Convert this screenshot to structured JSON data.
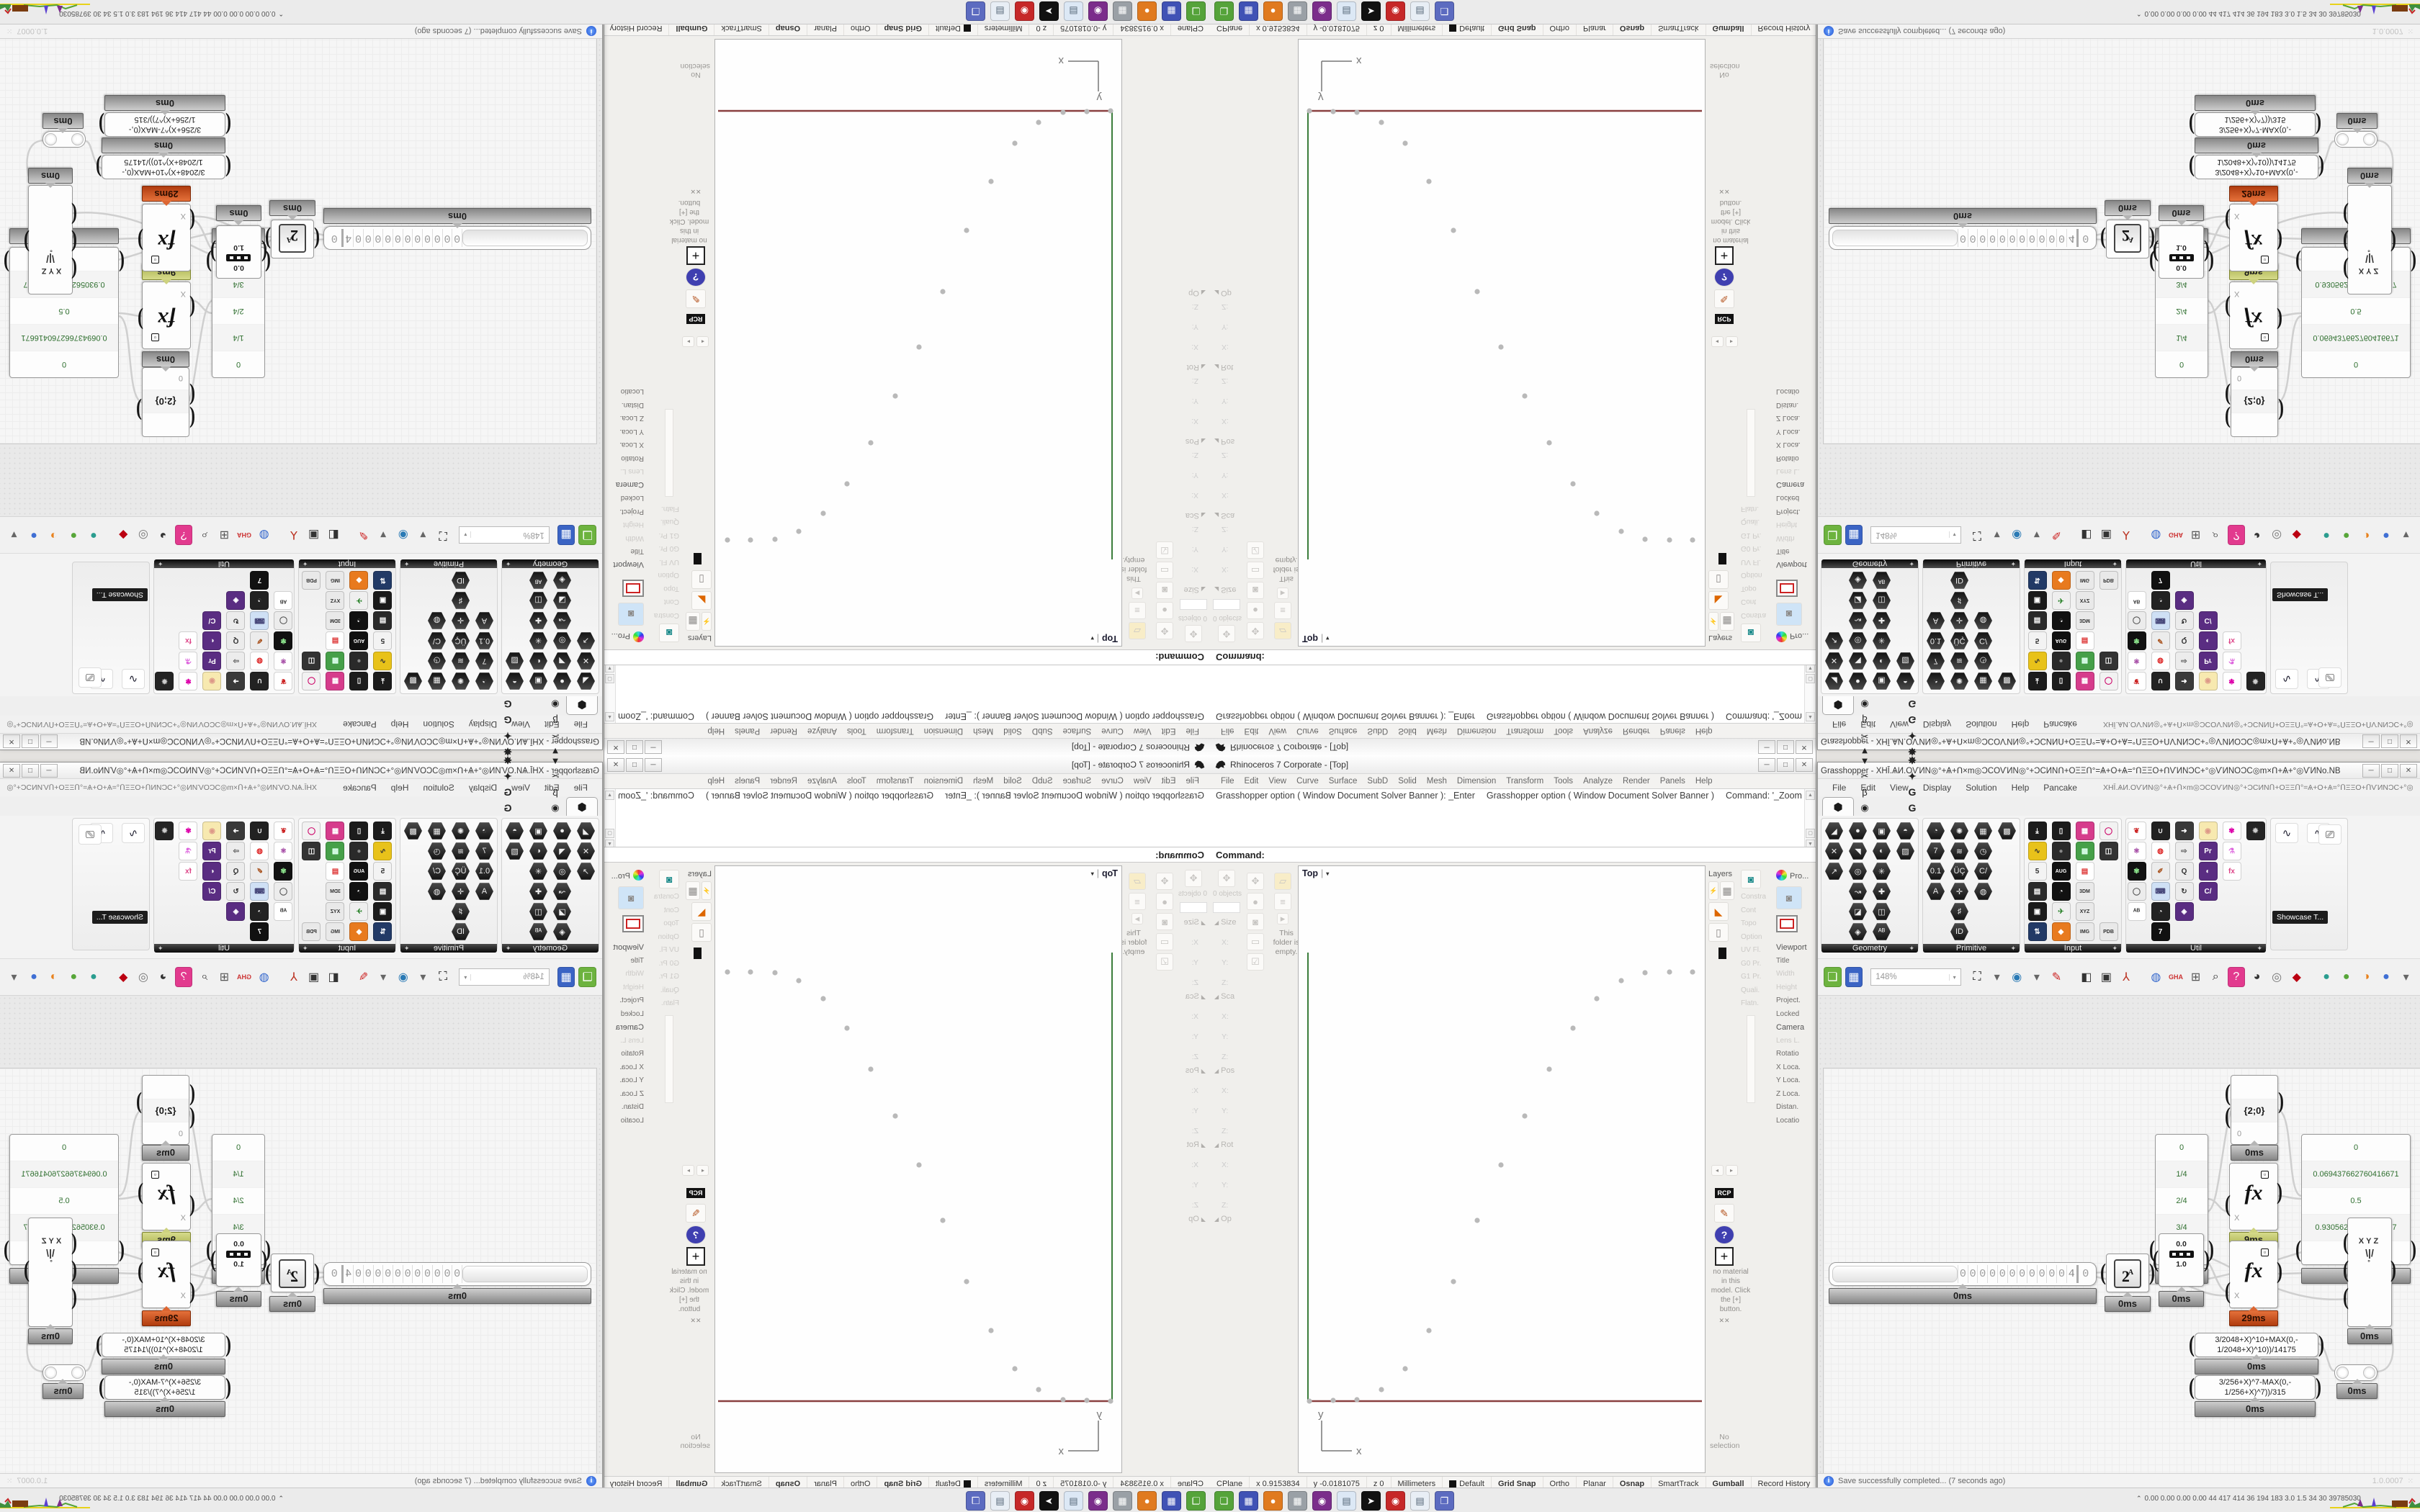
{
  "ui": {
    "hex_glyph": "⬢",
    "caret_down": "▾",
    "bracket_l": "(",
    "bracket_r": ")",
    "accent_red": "#b03c0f",
    "accent_olive": "#a9b14e",
    "wire_color": "#cfcfcf"
  },
  "rhino": {
    "title": "Rhinoceros 7 Corporate - [Top]",
    "window_buttons": [
      "─",
      "□",
      "✕"
    ],
    "menu": [
      "File",
      "Edit",
      "View",
      "Curve",
      "Surface",
      "SubD",
      "Solid",
      "Mesh",
      "Dimension",
      "Transform",
      "Tools",
      "Analyze",
      "Render",
      "Panels",
      "Help"
    ],
    "command_history": [
      "Grasshopper option ( Window  Document  Solver  Banner ): _Enter",
      "Grasshopper option ( Window  Document  Solver  Banner )",
      "Command: '_Zoom",
      "Drag a window to zoom ( All  Dynamic  Extents  Factor  In  Out  Selected  Target  1To1 ):  Extents"
    ],
    "command_prompt": "Command:",
    "left_panel": {
      "objects_label": "0 objects",
      "sections": [
        {
          "h": "Size",
          "f": [
            "X:",
            "Y:",
            "Z:"
          ]
        },
        {
          "h": "Sca",
          "f": [
            "X:",
            "Y:",
            "Z:"
          ]
        },
        {
          "h": "Pos",
          "f": [
            "X:",
            "Y:",
            "Z:"
          ]
        },
        {
          "h": "Rot",
          "f": [
            "X:",
            "Y:",
            "Z:"
          ]
        },
        {
          "h": "Op",
          "f": []
        }
      ],
      "col_icons": [
        "✥",
        "●",
        "◙",
        "▭",
        "☑"
      ],
      "folder_icon": "▱",
      "menu_icon": "≡",
      "expand_icon": "▸",
      "folder_note": "This folder is empty."
    },
    "viewport": {
      "label": "Top",
      "dropdown": "▾",
      "axis_x_label": "x",
      "axis_y_label": "y",
      "x_axis_color": "#8a4040",
      "y_axis_color": "#3c7d3c",
      "point_color": "#b9b9b9",
      "points": [
        [
          15,
          743
        ],
        [
          48,
          742
        ],
        [
          81,
          741
        ],
        [
          115,
          727
        ],
        [
          148,
          698
        ],
        [
          181,
          645
        ],
        [
          215,
          577
        ],
        [
          248,
          492
        ],
        [
          281,
          415
        ],
        [
          314,
          347
        ],
        [
          348,
          282
        ],
        [
          381,
          225
        ],
        [
          414,
          184
        ],
        [
          448,
          159
        ],
        [
          481,
          148
        ],
        [
          515,
          147
        ],
        [
          547,
          147
        ]
      ]
    },
    "right_panels": {
      "layers_title": "Layers",
      "layers_icons": [
        "⚡",
        "▦",
        "◣",
        "▯"
      ],
      "properties_title": "Pro...",
      "gear_icon": "⚙",
      "viewport_section": [
        {
          "t": "Viewport",
          "c": "ptitle"
        },
        {
          "t": "Title",
          "c": "drk"
        },
        {
          "t": "Width",
          "c": "faded"
        },
        {
          "t": "Height",
          "c": "faded"
        },
        {
          "t": "Project.",
          "c": "drk"
        },
        {
          "t": "Locked",
          "c": "drk"
        }
      ],
      "camera_section": [
        {
          "t": "Camera",
          "c": "ptitle"
        },
        {
          "t": "Lens L.",
          "c": "faded"
        },
        {
          "t": "Rotatio",
          "c": "drk"
        },
        {
          "t": "X Loca.",
          "c": "drk"
        },
        {
          "t": "Y Loca.",
          "c": "drk"
        },
        {
          "t": "Z Loca.",
          "c": "drk"
        },
        {
          "t": "Distan.",
          "c": "drk"
        },
        {
          "t": "Locatio",
          "c": "drk"
        }
      ],
      "mid_items": [
        {
          "t": "Constra",
          "c": "faded"
        },
        {
          "t": "Cont",
          "c": "faded"
        },
        {
          "t": "Topo",
          "c": "faded"
        },
        {
          "t": "Option",
          "c": "faded"
        },
        {
          "t": "UV Fl.",
          "c": "faded"
        },
        {
          "t": "G0 Pr.",
          "c": "faded"
        },
        {
          "t": "G1 Pr.",
          "c": "faded"
        },
        {
          "t": "Quali.",
          "c": "faded"
        },
        {
          "t": "Flatn.",
          "c": "faded"
        }
      ],
      "rcp_label": "RCP",
      "pencil_icon": "✎",
      "help_icon": "?",
      "plus_icon": "+",
      "material_note": "no material in this model. Click the [+] button.",
      "no_selection": "No selection"
    },
    "statusbar": [
      {
        "t": "CPlane"
      },
      {
        "t": "x 0.9153834"
      },
      {
        "t": "y -0.0181075"
      },
      {
        "t": "z 0"
      },
      {
        "t": "Millimeters"
      },
      {
        "t": "Default",
        "swatch": true
      },
      {
        "t": "Grid Snap",
        "b": true
      },
      {
        "t": "Ortho"
      },
      {
        "t": "Planar"
      },
      {
        "t": "Osnap",
        "b": true
      },
      {
        "t": "SmartTrack"
      },
      {
        "t": "Gumball",
        "b": true
      },
      {
        "t": "Record History"
      },
      {
        "t": "Filter"
      }
    ]
  },
  "grasshopper": {
    "title": "Grasshopper - XHĪ.ѦИ.ОѴИΝ◎°+Ѧ+Ո×m◎ϽϹΟѴИΝ◎°+ϽϹИΝՈ+ΟΞΞՈ°=Ѧ+Ο+Ѧ=°ՈΞΞΟ+ՈѴИΝϽϹ+°◎ѴИΝΟϽϹ◎m×Ո+Ѧ+°◎ѴИΝο.NB",
    "window_buttons": [
      "─",
      "□",
      "✕"
    ],
    "menu": [
      "File",
      "Edit",
      "View",
      "Display",
      "Solution",
      "Help",
      "Pancake"
    ],
    "menu_doc": "XHĪ.ѦИ.ОѴИΝ◎°+Ѧ+Ո×m◎ϽϹΟѴИΝ◎°+ϽϹИΝՈ+ΟΞΞՈ°=Ѧ+Ο+Ѧ=°ՈΞΞΟ+ՈѴИΝϽϹ+°◎ѴИΝΟϽϹ◎m×Ո+Ѧ+°◎ѴИΝο.NB",
    "params_tab_glyph": "⬢",
    "tabs_glyphs": [
      "Σ",
      "Ψ",
      "↗",
      "↺",
      "◗",
      "▼",
      "✂",
      "β",
      "◉"
    ],
    "tabs_letters": [
      "A",
      "❀",
      "A",
      "B",
      "▲",
      "B",
      "◈",
      "♞",
      "D",
      "E",
      "E",
      "E",
      "F",
      "✱",
      "✸",
      "✦",
      "G",
      "G"
    ],
    "ribbon": [
      {
        "name": "Geometry",
        "cols": 4,
        "style": "hex",
        "icons": [
          "◢",
          "●",
          "▣",
          "◓",
          "✕",
          "◥",
          "◐",
          "▨",
          "↗",
          "◎",
          "✳",
          "",
          "",
          "↝",
          "✚",
          "",
          "",
          "◪",
          "◫",
          "",
          "",
          "◈",
          "ᴬᴮ",
          ""
        ]
      },
      {
        "name": "Primitive",
        "cols": 4,
        "style": "hex",
        "icons": [
          "◔",
          "✺",
          "▦",
          "▩",
          "7",
          "≋",
          "◷",
          "",
          "0.1",
          "ÜÇ",
          "C/",
          "",
          "A",
          "✛",
          "◍",
          "",
          "",
          "♯",
          "",
          "",
          "",
          "ID",
          "",
          ""
        ]
      },
      {
        "name": "Input",
        "cols": 4,
        "style": "color",
        "icons": [
          {
            "g": "⤓",
            "b": "#1c1c1c",
            "f": "#fff"
          },
          {
            "g": "▯",
            "b": "#1c1c1c",
            "f": "#fff"
          },
          {
            "g": "▦",
            "b": "#d63c8c",
            "f": "#fff"
          },
          {
            "g": "◯",
            "b": "#f2f2f2",
            "f": "#c06"
          },
          {
            "g": "∿",
            "b": "#e8c21a",
            "f": "#333"
          },
          {
            "g": "●",
            "b": "#2a2a2a",
            "f": "#888"
          },
          {
            "g": "▩",
            "b": "#46a049",
            "f": "#dfe"
          },
          {
            "g": "◫",
            "b": "#333",
            "f": "#fff"
          },
          {
            "g": "5",
            "b": "#f3f3f3",
            "f": "#333"
          },
          {
            "g": "AUG",
            "b": "#111",
            "f": "#fff"
          },
          {
            "g": "▤",
            "b": "#fff",
            "f": "#d33"
          },
          {
            "g": ""
          },
          {
            "g": "▤",
            "b": "#2a2a2a",
            "f": "#fff"
          },
          {
            "g": "◔",
            "b": "#111",
            "f": "#fff"
          },
          {
            "g": "3DM",
            "b": "#e9e9e9",
            "f": "#333"
          },
          {
            "g": ""
          },
          {
            "g": "▣",
            "b": "#1a1a1a",
            "f": "#fff"
          },
          {
            "g": "✈",
            "b": "#efefef",
            "f": "#383"
          },
          {
            "g": "XYZ",
            "b": "#e9e9e9",
            "f": "#333"
          },
          {
            "g": ""
          },
          {
            "g": "⇅",
            "b": "#223a66",
            "f": "#fff"
          },
          {
            "g": "◆",
            "b": "#e87a1e",
            "f": "#fff"
          },
          {
            "g": "IMG",
            "b": "#e9e9e9",
            "f": "#333"
          },
          {
            "g": "PDB",
            "b": "#e9e9e9",
            "f": "#333"
          }
        ]
      },
      {
        "name": "Util",
        "cols": 6,
        "style": "color",
        "icons": [
          {
            "g": "❦",
            "b": "#fff",
            "f": "#c22"
          },
          {
            "g": "∪",
            "b": "#222",
            "f": "#eee"
          },
          {
            "g": "➜",
            "b": "#3a3a3a",
            "f": "#fff"
          },
          {
            "g": "◉",
            "b": "#f7e9b0",
            "f": "#d98"
          },
          {
            "g": "✾",
            "b": "#fff",
            "f": "#d0a"
          },
          {
            "g": "✹",
            "b": "#242424",
            "f": "#ccc"
          },
          {
            "g": "⚛",
            "b": "#fff",
            "f": "#939"
          },
          {
            "g": "◍",
            "b": "#fff",
            "f": "#d22"
          },
          {
            "g": "⇨",
            "b": "#ececec",
            "f": "#555"
          },
          {
            "g": "Pr",
            "b": "#5a2d82",
            "f": "#fff"
          },
          {
            "g": "⚗",
            "b": "#fff",
            "f": "#d6d"
          },
          {
            "g": ""
          },
          {
            "g": "✾",
            "b": "#111",
            "f": "#8d8"
          },
          {
            "g": "✐",
            "b": "#ececec",
            "f": "#a52"
          },
          {
            "g": "Q",
            "b": "#ececec",
            "f": "#333"
          },
          {
            "g": "◐",
            "b": "#5a2d82",
            "f": "#fff"
          },
          {
            "g": "fx",
            "b": "#fff",
            "f": "#d48"
          },
          {
            "g": ""
          },
          {
            "g": "◯",
            "b": "#ececec",
            "f": "#555"
          },
          {
            "g": "⌨",
            "b": "#cfe0f5",
            "f": "#447"
          },
          {
            "g": "↻",
            "b": "#ececec",
            "f": "#333"
          },
          {
            "g": "C/",
            "b": "#5a2d82",
            "f": "#fff"
          },
          {
            "g": ""
          },
          {
            "g": ""
          },
          {
            "g": "ᴬᴮ",
            "b": "#fff",
            "f": "#333"
          },
          {
            "g": "◔",
            "b": "#222",
            "f": "#fff"
          },
          {
            "g": "◈",
            "b": "#5a2d82",
            "f": "#fff"
          },
          {
            "g": ""
          },
          {
            "g": ""
          },
          {
            "g": ""
          },
          {
            "g": "",
            "b": ""
          },
          {
            "g": "7",
            "b": "#111",
            "f": "#fff"
          },
          {
            "g": ""
          },
          {
            "g": ""
          },
          {
            "g": ""
          },
          {
            "g": ""
          }
        ]
      }
    ],
    "showcase": {
      "icons": [
        "∿",
        "∿"
      ],
      "screen_icon": "⎚",
      "label": "Showcase T..."
    },
    "toolbar": {
      "zoom_value": "148%",
      "icons": [
        {
          "g": "❏",
          "b": "#6db33f",
          "f": "#fff",
          "n": "new-document-icon"
        },
        {
          "g": "▦",
          "b": "#3b64c4",
          "f": "#fff",
          "n": "save-icon"
        },
        {
          "g": "ZOOMBOX"
        },
        {
          "g": "⛶",
          "f": "#222",
          "n": "zoom-extents-icon"
        },
        {
          "g": "▾",
          "f": "#666",
          "n": "zoom-dropdown-icon"
        },
        {
          "g": "◉",
          "f": "#2a7ab5",
          "n": "preview-eye-icon"
        },
        {
          "g": "▾",
          "f": "#666",
          "n": "eye-dropdown-icon"
        },
        {
          "g": "✎",
          "f": "#c22",
          "n": "sketch-pen-icon"
        },
        {
          "g": "SEP"
        },
        {
          "g": "◧",
          "f": "#333",
          "n": "speaker-icon"
        },
        {
          "g": "▣",
          "f": "#333",
          "n": "box-icon"
        },
        {
          "g": "⅄",
          "f": "#b32",
          "n": "tripod-icon"
        },
        {
          "g": "SEP"
        },
        {
          "g": "◍",
          "f": "#36c",
          "n": "globe-icon"
        },
        {
          "g": "GHA",
          "f": "#c33",
          "sm": true,
          "n": "gha-icon"
        },
        {
          "g": "⊞",
          "f": "#555",
          "n": "window-icon"
        },
        {
          "g": "⌕",
          "f": "#333",
          "n": "magnifier-icon"
        },
        {
          "g": "?",
          "b": "#e23a8e",
          "f": "#fff",
          "n": "help-box-icon"
        },
        {
          "g": "◕",
          "f": "#333",
          "n": "cookie-icon"
        },
        {
          "g": "◎",
          "f": "#777",
          "n": "rings-icon"
        },
        {
          "g": "◆",
          "f": "#b01",
          "n": "gem-icon"
        },
        {
          "g": "SEP"
        },
        {
          "g": "●",
          "f": "#2a9d8f",
          "n": "teal-ball-icon"
        },
        {
          "g": "●",
          "f": "#57a639",
          "n": "green-ball-icon"
        },
        {
          "g": "◑",
          "f": "#e8821e",
          "n": "orange-ball-icon"
        },
        {
          "g": "●",
          "f": "#3f6fd4",
          "n": "blue-ball-icon"
        },
        {
          "g": "▾",
          "f": "#666",
          "n": "ball-dropdown-icon"
        }
      ]
    },
    "canvas": {
      "path_panel": {
        "rows": [
          "",
          "{2;0}",
          "0"
        ],
        "tag": "0ms"
      },
      "quarters_panel": {
        "rows": [
          "0",
          "1/4",
          "2/4",
          "3/4",
          "4/4"
        ],
        "tag": "0ms"
      },
      "values_panel": {
        "rows": [
          "0",
          "0.069437662760416671",
          "0.5",
          "0.93056233723958337",
          "1"
        ],
        "tag": "0ms"
      },
      "fx_top": {
        "x_label": "X",
        "fx_label": "fx",
        "tag": "9ms"
      },
      "fx_bottom": {
        "x_label": "X",
        "fx_label": "fx",
        "tag": "29ms"
      },
      "slider": {
        "digits": [
          "0",
          "0",
          "0",
          "0",
          "0",
          "0",
          "0",
          "0",
          "0",
          "0",
          "0"
        ],
        "value": "4",
        "end_digit": "0",
        "tag": "0ms"
      },
      "pow": {
        "base": "2",
        "exp": "A",
        "tag": "0ms"
      },
      "remap": {
        "top": "0.0",
        "bottom": "1.0",
        "tag": "0ms"
      },
      "xyz": {
        "label": "XYZ",
        "funnel": "\\|/",
        "dot": "°",
        "tag": "0ms"
      },
      "expr1": {
        "lines": [
          "3/2048+X)^10+MAX(0,-",
          "1/2048+X)^10))/14175"
        ],
        "tag": "0ms"
      },
      "expr2": {
        "lines": [
          "3/256+X)^7-MAX(0,-",
          "1/256+X)^7))/315"
        ],
        "tag": "0ms"
      },
      "relay": {
        "tag": "0ms"
      },
      "wires": [
        [
          370,
          385,
          385,
          385,
          392,
          384,
          400,
          384
        ],
        [
          458,
          384,
          466,
          384,
          465,
          366,
          473,
          366
        ],
        [
          534,
          366,
          550,
          366,
          552,
          412,
          571,
          412
        ],
        [
          540,
          282,
          556,
          282,
          556,
          300,
          571,
          300
        ],
        [
          637,
          158,
          662,
          158,
          650,
          275,
          671,
          278
        ],
        [
          637,
          278,
          652,
          278,
          656,
          282,
          671,
          282
        ],
        [
          637,
          386,
          678,
          386,
          695,
          383,
          735,
          383
        ],
        [
          385,
          390,
          540,
          430,
          650,
          345,
          735,
          345
        ],
        [
          458,
          388,
          505,
          388,
          528,
          420,
          571,
          416
        ],
        [
          534,
          362,
          560,
          362,
          640,
          430,
          735,
          421
        ],
        [
          693,
          483,
          708,
          483,
          707,
          521,
          717,
          521
        ],
        [
          775,
          522,
          800,
          522,
          802,
          490,
          795,
          468
        ],
        [
          540,
          300,
          556,
          300,
          560,
          210,
          573,
          160
        ]
      ]
    },
    "statusbar": {
      "message": "Save successfully completed... (7 seconds ago)",
      "version": "1.0.0007",
      "grip": "⁙"
    }
  },
  "taskbar": {
    "chevron": "⌃",
    "stats": "0.00 0.00 0.00 0.00   44   417   414   36   194   183   3.0   1.5   34   30   39785030",
    "apps": [
      {
        "b": "#55a33a",
        "g": "❏"
      },
      {
        "b": "#4052b5",
        "g": "▦"
      },
      {
        "b": "#e07a1f",
        "g": "●"
      },
      {
        "b": "#9aa0a6",
        "g": "▦"
      },
      {
        "b": "#7b2d8b",
        "g": "◉"
      },
      {
        "b": "#dce8f5",
        "g": "▤",
        "f": "#567"
      },
      {
        "b": "#111111",
        "g": "➤"
      },
      {
        "b": "#c62828",
        "g": "◉"
      },
      {
        "b": "#e8eef5",
        "g": "▤",
        "f": "#567"
      },
      {
        "b": "#5c6bc0",
        "g": "❐"
      }
    ]
  }
}
